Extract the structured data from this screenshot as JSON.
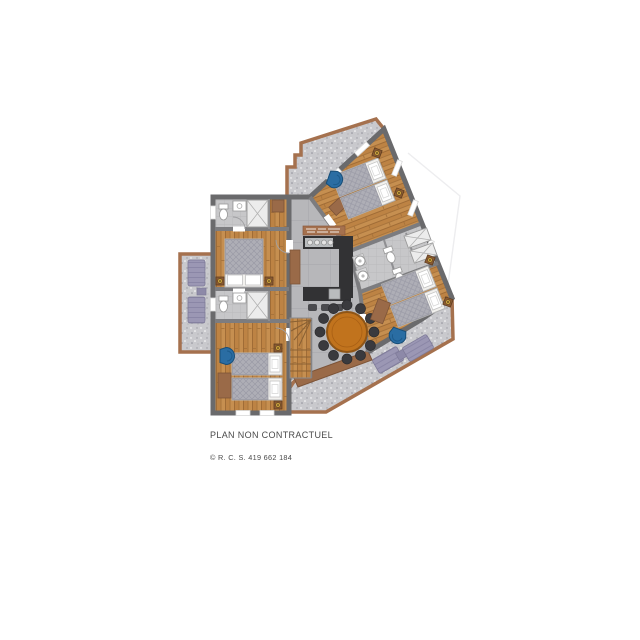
{
  "captions": {
    "disclaimer": "PLAN NON CONTRACTUEL",
    "copyright": "© R. C. S. 419 662 184"
  },
  "palette": {
    "wall": "#6a6a6c",
    "wood": "#c38e52",
    "terrace": "#c9c9cd",
    "terrace_border": "#a5714e",
    "living_tile": "#b7b7ba",
    "bath_tile": "#c7c7c9",
    "kitchen_counter": "#323234",
    "steel": "#b9bcbe",
    "dining_table_orange": "#c1731d",
    "dining_chair": "#3a3a3e",
    "accent_armchair_blue": "#2a6da3",
    "lounger_purple": "#9b97b4",
    "furniture_brown": "#9a6a48",
    "nightstand_knob_gold": "#c9a03f",
    "text": "#4a4a4a"
  }
}
